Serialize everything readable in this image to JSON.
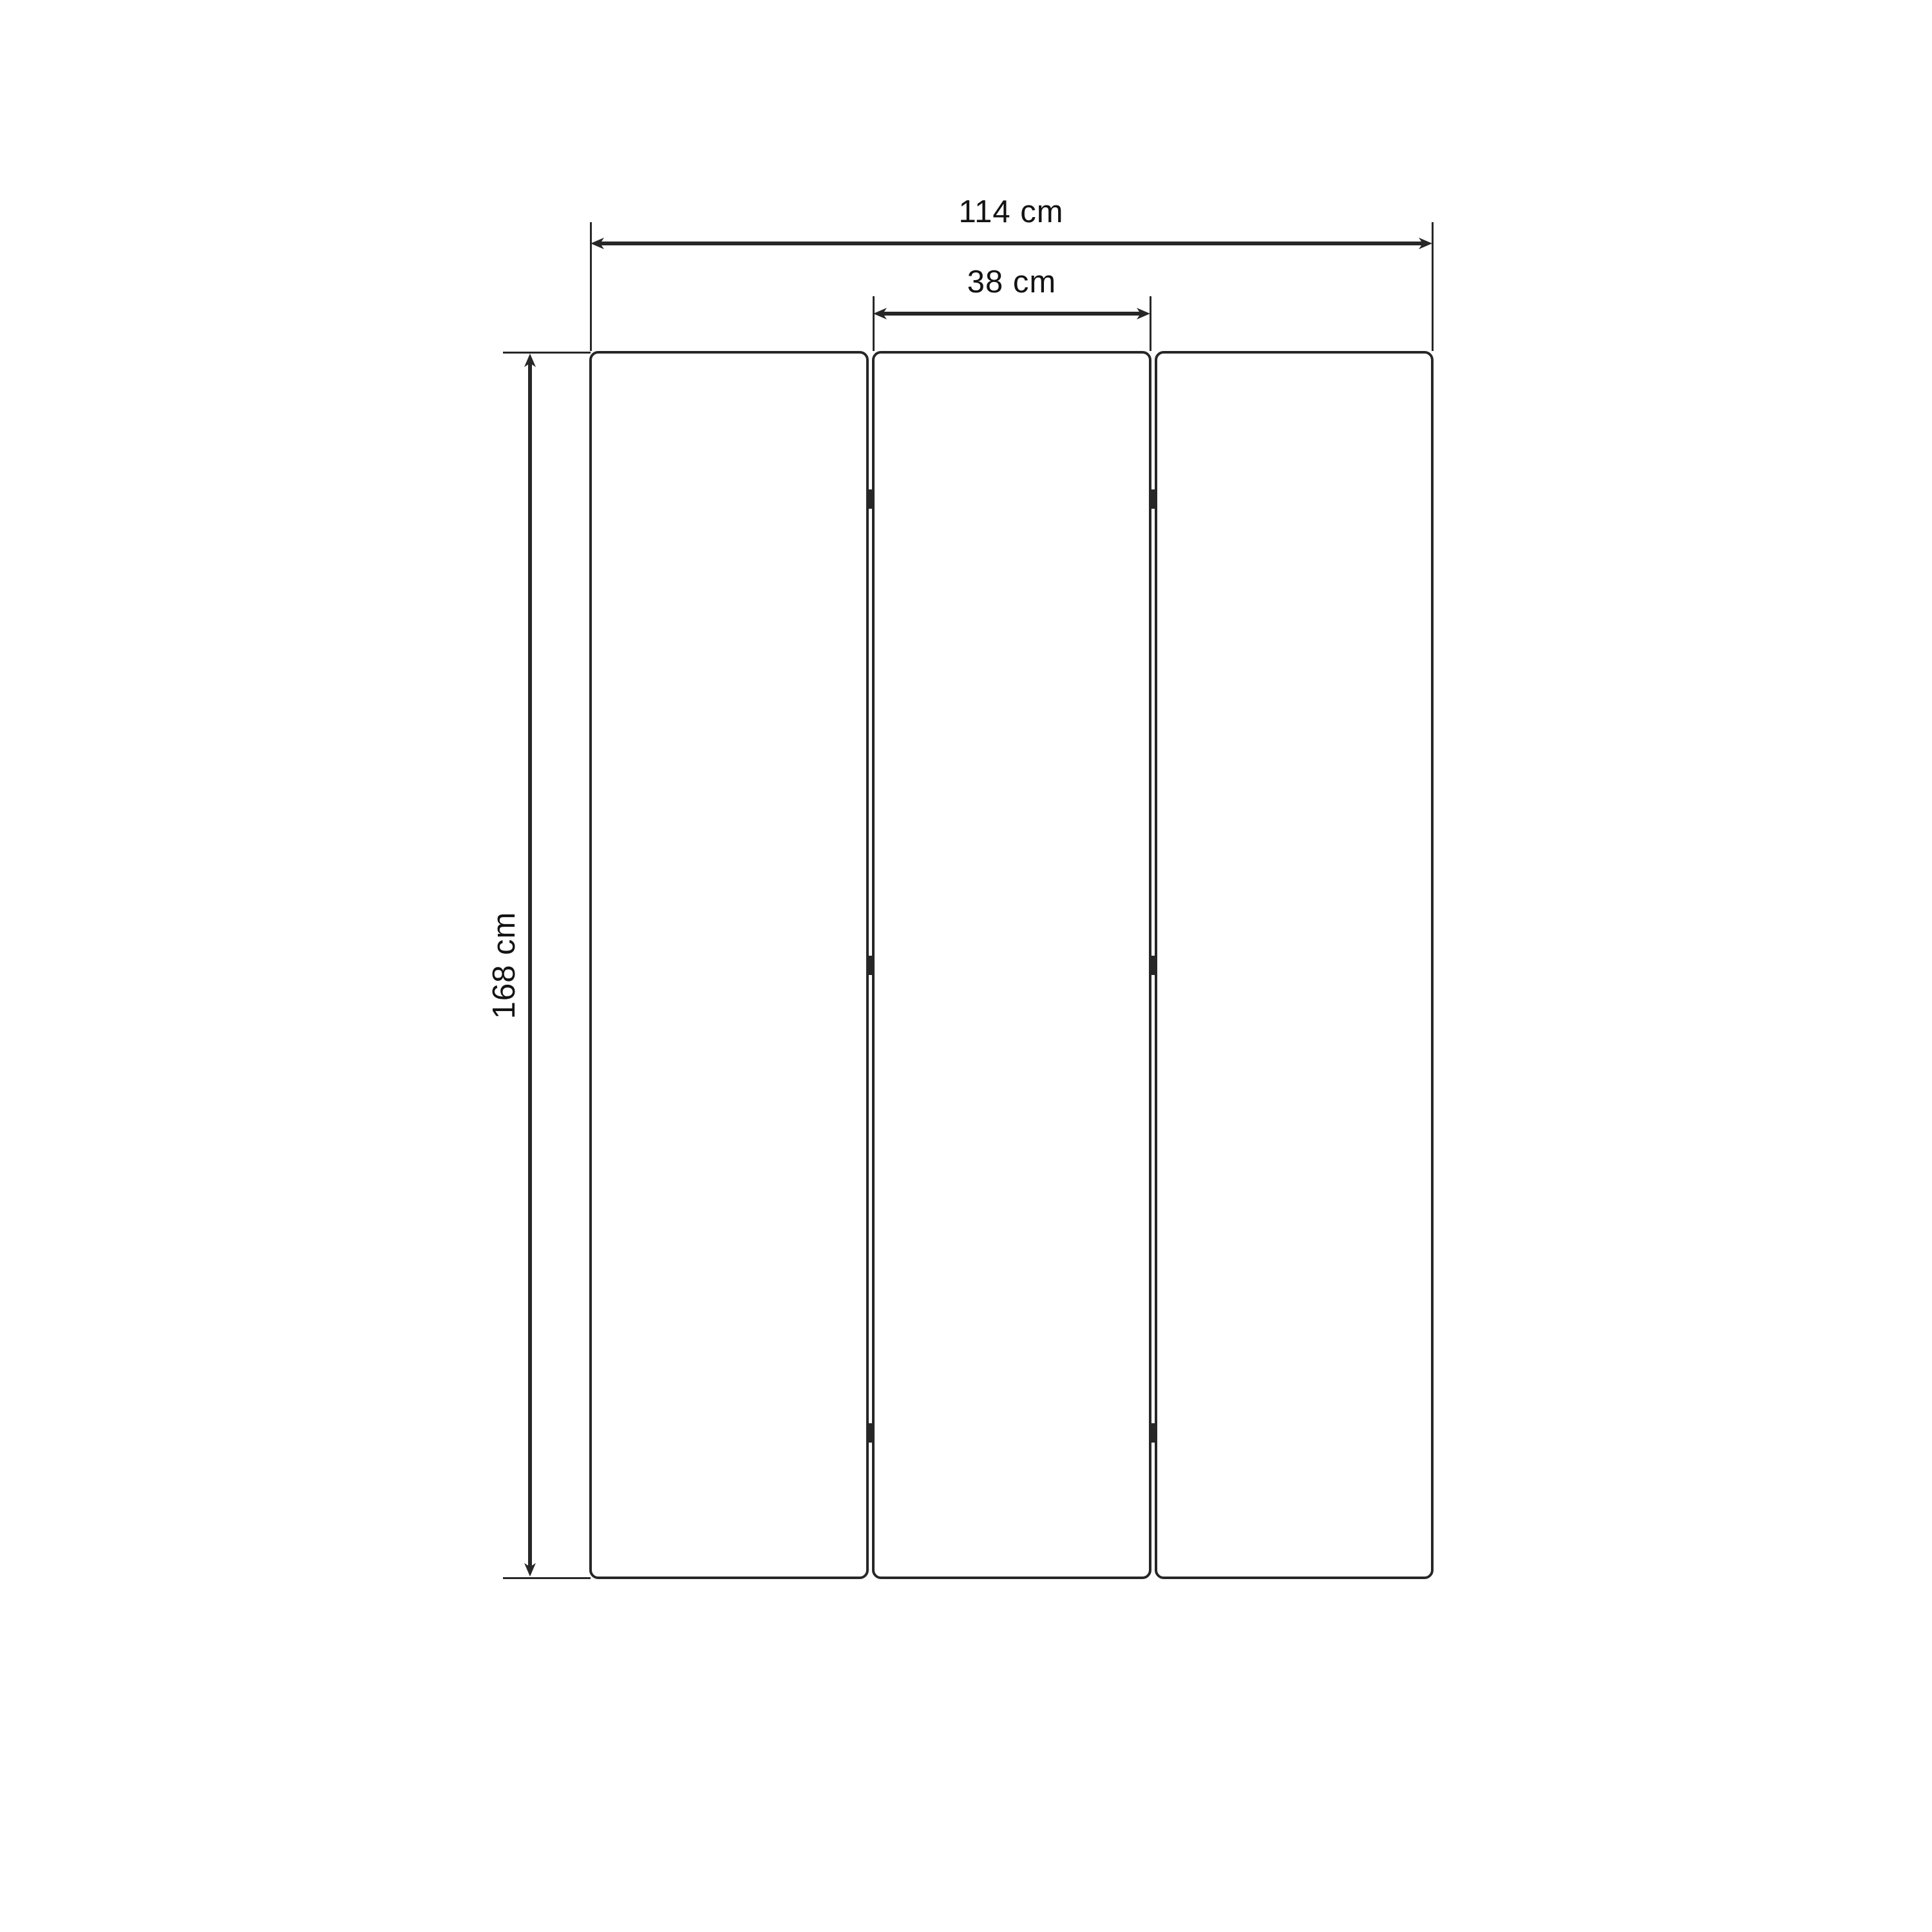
{
  "diagram": {
    "unit": "cm",
    "panel_count": 3,
    "hinge_marks_per_gap": 3,
    "dimensions": {
      "overall_width": {
        "value": 114,
        "unit": "cm",
        "label": "114 cm"
      },
      "panel_width": {
        "value": 38,
        "unit": "cm",
        "label": "38 cm"
      },
      "height": {
        "value": 168,
        "unit": "cm",
        "label": "168 cm"
      }
    },
    "colors": {
      "ink": "#272727",
      "text": "#131313",
      "background": "#ffffff"
    }
  }
}
